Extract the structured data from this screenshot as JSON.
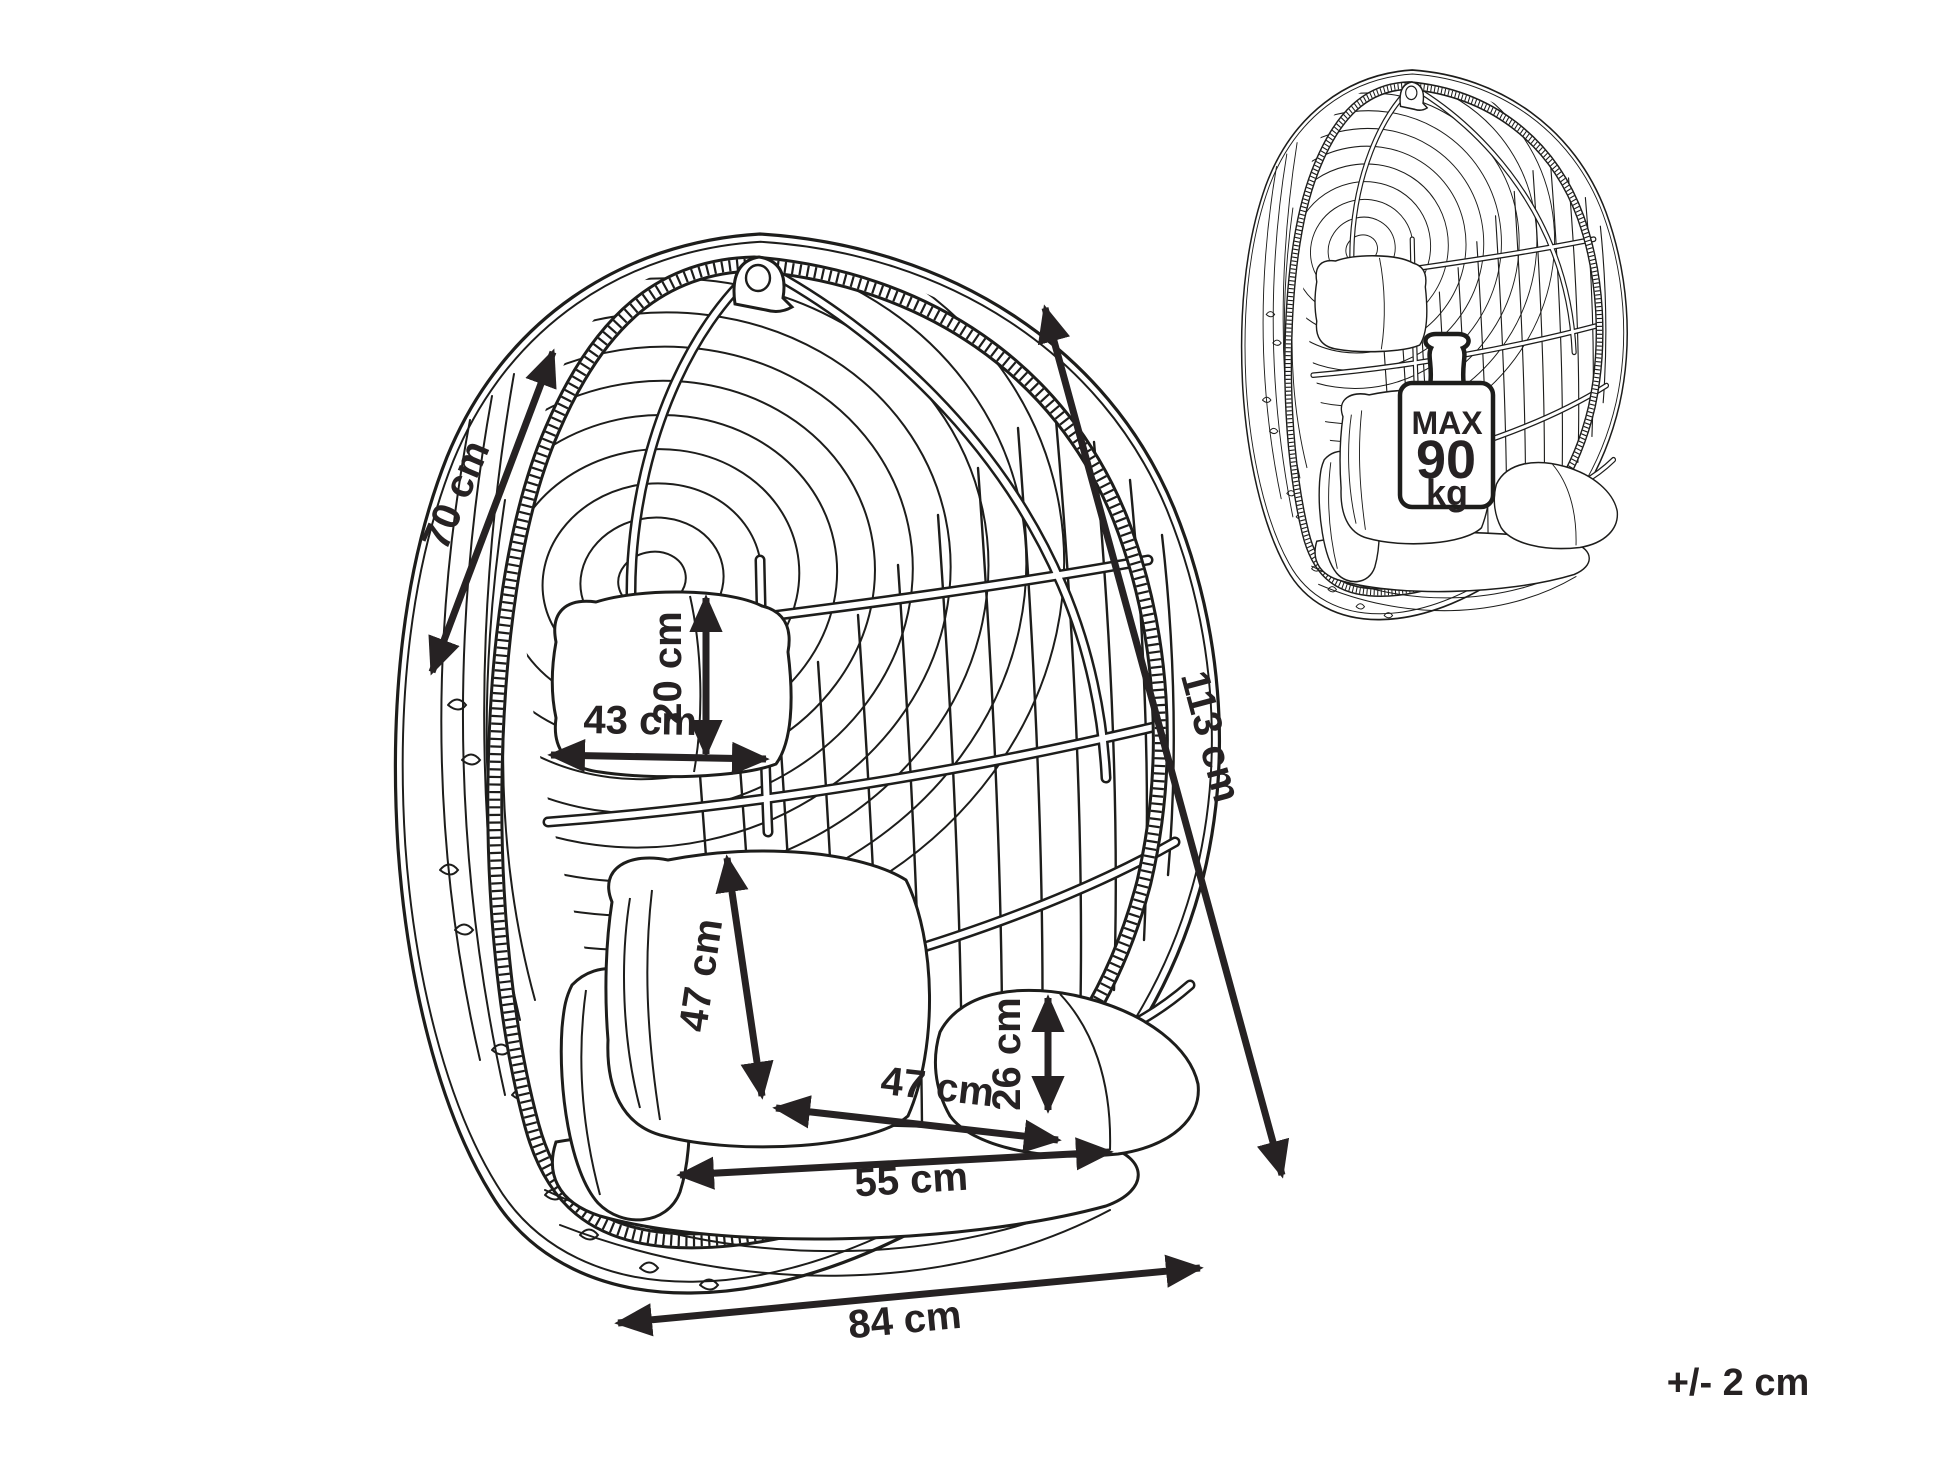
{
  "diagram": {
    "tolerance": "+/- 2 cm",
    "dimensions": {
      "depth": "70 cm",
      "height": "113 cm",
      "width": "84 cm",
      "pillow_width": "43 cm",
      "pillow_height": "20 cm",
      "backrest_height": "47 cm",
      "seat_depth": "47 cm",
      "seat_width": "55 cm",
      "cushion_height": "26 cm"
    },
    "max_load": {
      "label": "MAX",
      "value": "90",
      "unit": "kg"
    },
    "colors": {
      "line": "#1d1d1b",
      "dimension": "#262223",
      "background": "#ffffff"
    }
  }
}
